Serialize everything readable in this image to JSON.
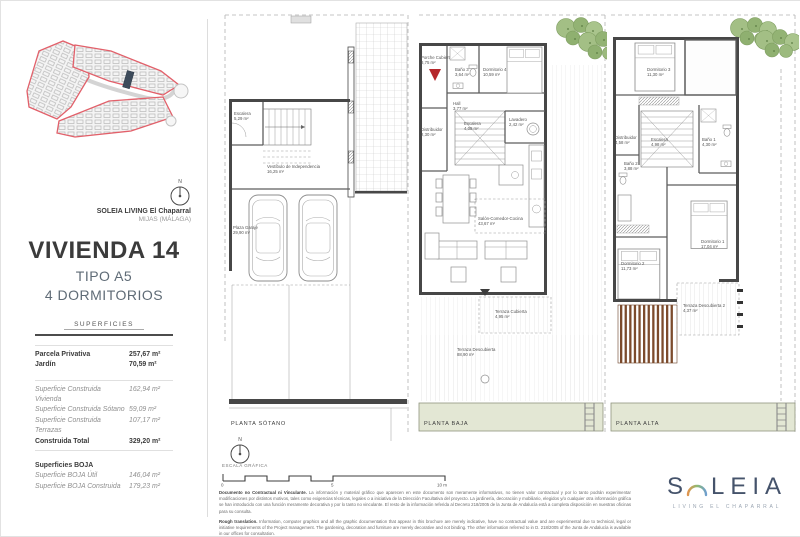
{
  "sidebar": {
    "north_label": "N",
    "project_name": "SOLEIA LIVING El Chaparral",
    "project_location": "MIJAS (MÁLAGA)",
    "title": "VIVIENDA 14",
    "type": "TIPO A5",
    "bedrooms": "4 DORMITORIOS",
    "superficies_header": "SUPERFICIES",
    "rows": [
      {
        "label": "Parcela Privativa",
        "value": "257,67 m²"
      },
      {
        "label": "Jardín",
        "value": "70,59 m²"
      },
      {
        "label": "Superficie Construida Vivienda",
        "value": "162,94 m²"
      },
      {
        "label": "Superficie Construida Sótano",
        "value": "59,09 m²"
      },
      {
        "label": "Superficie Construida Terrazas",
        "value": "107,17 m²"
      },
      {
        "label": "Construida Total",
        "value": "329,20 m²"
      },
      {
        "label": "Superficies BOJA",
        "value": ""
      },
      {
        "label": "Superficie BOJA Útil",
        "value": "146,04 m²"
      },
      {
        "label": "Superficie BOJA Construida",
        "value": "179,23 m²"
      }
    ]
  },
  "plans": {
    "sotano": {
      "name": "PLANTA SÓTANO",
      "rooms": {
        "escalera": {
          "label": "Escalera",
          "area": "5,29 m²"
        },
        "vestibulo": {
          "label": "Vestíbulo de Independencia",
          "area": "16,25 m²"
        },
        "garaje": {
          "label": "Plaza Garaje",
          "area": "29,90 m²"
        }
      }
    },
    "baja": {
      "name": "PLANTA BAJA",
      "rooms": {
        "porche": {
          "label": "Porche Cubierto",
          "area": "8,75 m²"
        },
        "bano3": {
          "label": "Baño 3",
          "area": "3,64 m²"
        },
        "dormitorio4": {
          "label": "Dormitorio 4",
          "area": "10,59 m²"
        },
        "hall": {
          "label": "Hall",
          "area": "3,77 m²"
        },
        "distribuidor": {
          "label": "Distribuidor",
          "area": "2,30 m²"
        },
        "escalera": {
          "label": "Escalera",
          "area": "4,08 m²"
        },
        "lavadero": {
          "label": "Lavadero",
          "area": "2,42 m²"
        },
        "salon": {
          "label": "Salón-Comedor-Cocina",
          "area": "43,67 m²"
        },
        "terraza_cubierta": {
          "label": "Terraza Cubierta",
          "area": "4,95 m²"
        },
        "terraza_descubierta": {
          "label": "Terraza Descubierta",
          "area": "88,90 m²"
        }
      }
    },
    "alta": {
      "name": "PLANTA ALTA",
      "rooms": {
        "dormitorio3": {
          "label": "Dormitorio 3",
          "area": "11,30 m²"
        },
        "distribuidor": {
          "label": "Distribuidor",
          "area": "4,58 m²"
        },
        "escalera": {
          "label": "Escalera",
          "area": "4,98 m²"
        },
        "bano1": {
          "label": "Baño 1",
          "area": "4,30 m²"
        },
        "bano2": {
          "label": "Baño 2",
          "area": "3,88 m²"
        },
        "dormitorio1": {
          "label": "Dormitorio 1",
          "area": "17,04 m²"
        },
        "dormitorio2": {
          "label": "Dormitorio 2",
          "area": "11,73 m²"
        },
        "terraza2": {
          "label": "Terraza Descubierta 2",
          "area": "4,37 m²"
        }
      }
    }
  },
  "footer": {
    "north_label": "N",
    "scale_label": "ESCALA GRÁFICA",
    "scale_ticks": {
      "start": "0",
      "mid": "5",
      "end": "10 m"
    },
    "disclaimer_es_title": "Documento no Contractual ni Vinculante.",
    "disclaimer_es": "La información y material gráfico que aparecen en este documento son meramente informativos, no tienen valor contractual y por lo tanto podrán experimentar modificaciones por distintos motivos, tales como exigencias técnicas, legales o a iniciativa de la Dirección Facultativa del proyecto. La jardinería, decoración y mobiliario, elegidos y/o cualquier otra información gráfica se han introducido con una función meramente decorativa y por lo tanto no vinculante. El resto de la información referida al Decreto 218/2005 de la Junta de Andalucía está a completa disposición en nuestras oficinas para su consulta.",
    "disclaimer_en_title": "Rough translation.",
    "disclaimer_en": "Information, computer graphics and all the graphic documentation that appear in this brochure are merely indicative, have no contractual value and are experimental due to technical, legal or initiative requirements of the Project management. The gardening, decoration and furniture are merely decorative and not binding. The other information referred to in D. 218/2005 of the Junta de Andalucía is available in our offices for consultation."
  },
  "logo": {
    "brand_left": "S",
    "brand_right": "LEIA",
    "tagline": "LIVING EL CHAPARRAL"
  },
  "colors": {
    "accent_red": "#b5272b",
    "site_outline": "#e2606a",
    "vegetation_green": "#9cba7e",
    "pergola_brown": "#7c4b2c",
    "logo_navy": "#45536b"
  }
}
